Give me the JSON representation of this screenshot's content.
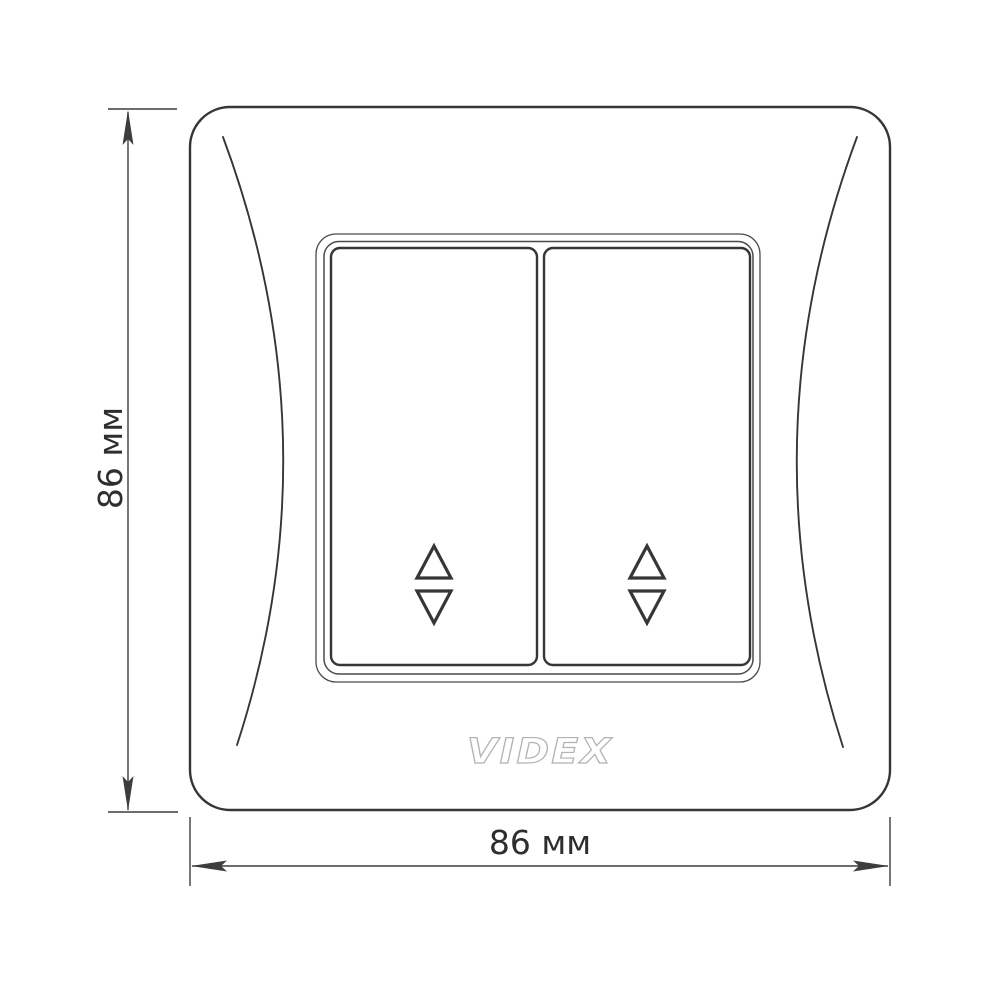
{
  "diagram": {
    "kind": "product-dimension-drawing",
    "height_dimension": {
      "label": "86 мм"
    },
    "width_dimension": {
      "label": "86 мм"
    }
  },
  "plate": {
    "brand": "VIDEX",
    "rocker_count": 2,
    "rocker_symbol": "up-down-arrow-icon"
  },
  "colors": {
    "background": "#ffffff",
    "line": "#363636",
    "frame_line": "#4a4a4a",
    "dimension_line": "#3d3d3d",
    "text": "#2e2e2e",
    "logo_outline": "#b3b3b3",
    "logo_fill": "#ffffff"
  }
}
